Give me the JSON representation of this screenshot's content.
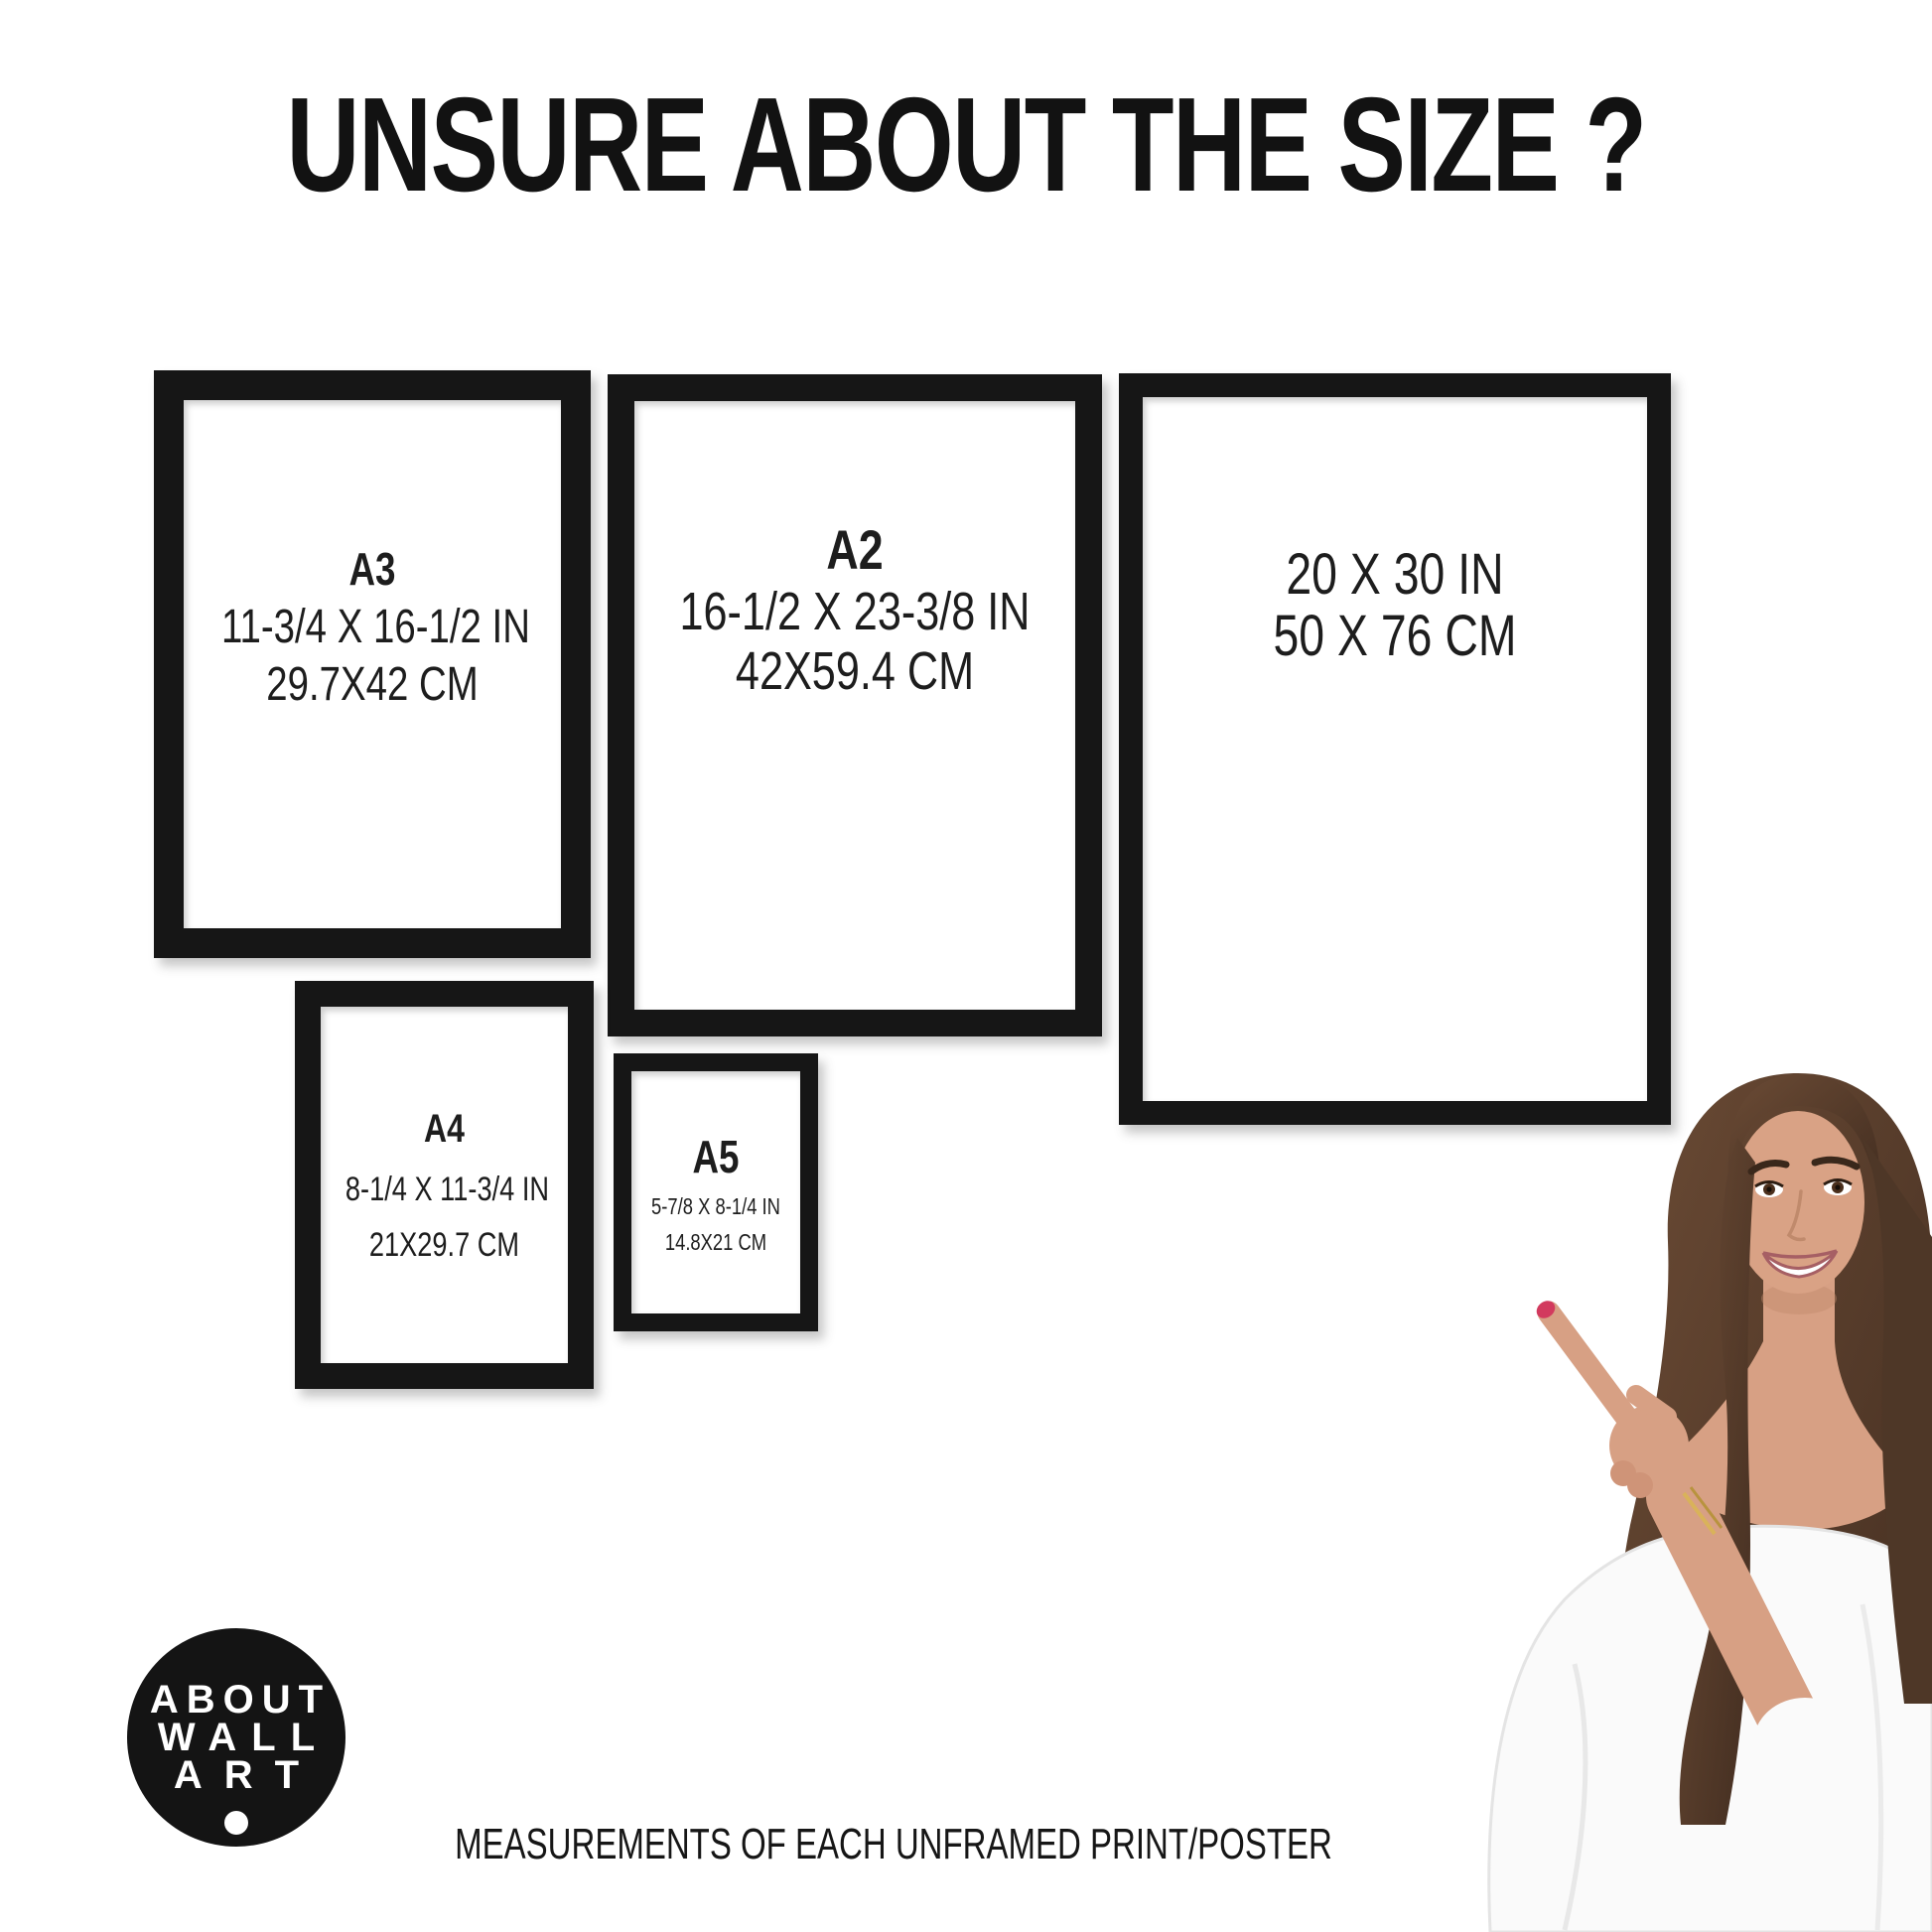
{
  "header": {
    "title": "UNSURE ABOUT THE SIZE ?"
  },
  "footer": {
    "caption": "MEASUREMENTS OF EACH UNFRAMED PRINT/POSTER"
  },
  "logo": {
    "line1": "ABOUT",
    "line2": "WALL",
    "line3": "ART"
  },
  "frames": {
    "a3": {
      "label": "A3",
      "inches": "11-3/4 X 16-1/2 IN",
      "cm": "29.7X42 CM"
    },
    "a2": {
      "label": "A2",
      "inches": "16-1/2 X 23-3/8 IN",
      "cm": "42X59.4 CM"
    },
    "size20x30": {
      "inches": "20 X 30 IN",
      "cm": "50 X 76 CM"
    },
    "a4": {
      "label": "A4",
      "inches": "8-1/4 X 11-3/4 IN",
      "cm": "21X29.7 CM"
    },
    "a5": {
      "label": "A5",
      "inches": "5-7/8 X 8-1/4 IN",
      "cm": "14.8X21 CM"
    }
  },
  "colors": {
    "frame": "#161616",
    "background": "#ffffff",
    "text": "#1d1d1d",
    "logo_bg": "#141414",
    "logo_text": "#ffffff",
    "nail": "#d23a5e"
  }
}
